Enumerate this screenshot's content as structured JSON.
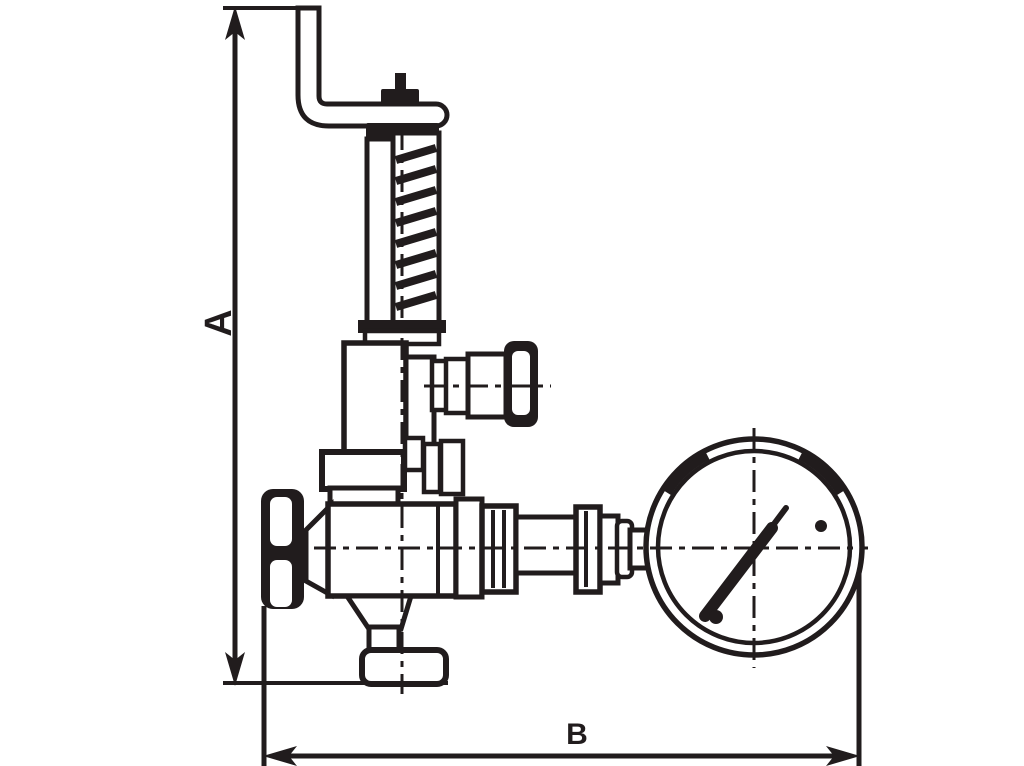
{
  "page": {
    "background": "#ffffff"
  },
  "drawing": {
    "kind": "technical-dimension-drawing",
    "subject": "spring-loaded safety relief valve with lever, handwheel and pressure gauge",
    "line_color": "#211c1d",
    "labels": {
      "dim_a": "A",
      "dim_b": "B"
    },
    "components": [
      "lever-arm",
      "stem-post",
      "spring-cap",
      "spring-guide-rod",
      "spring-coil",
      "bonnet",
      "test-valve-knob",
      "gland-union",
      "handwheel",
      "valve-body",
      "inlet-flange",
      "outlet-connector",
      "pressure-gauge",
      "gauge-needle"
    ]
  }
}
